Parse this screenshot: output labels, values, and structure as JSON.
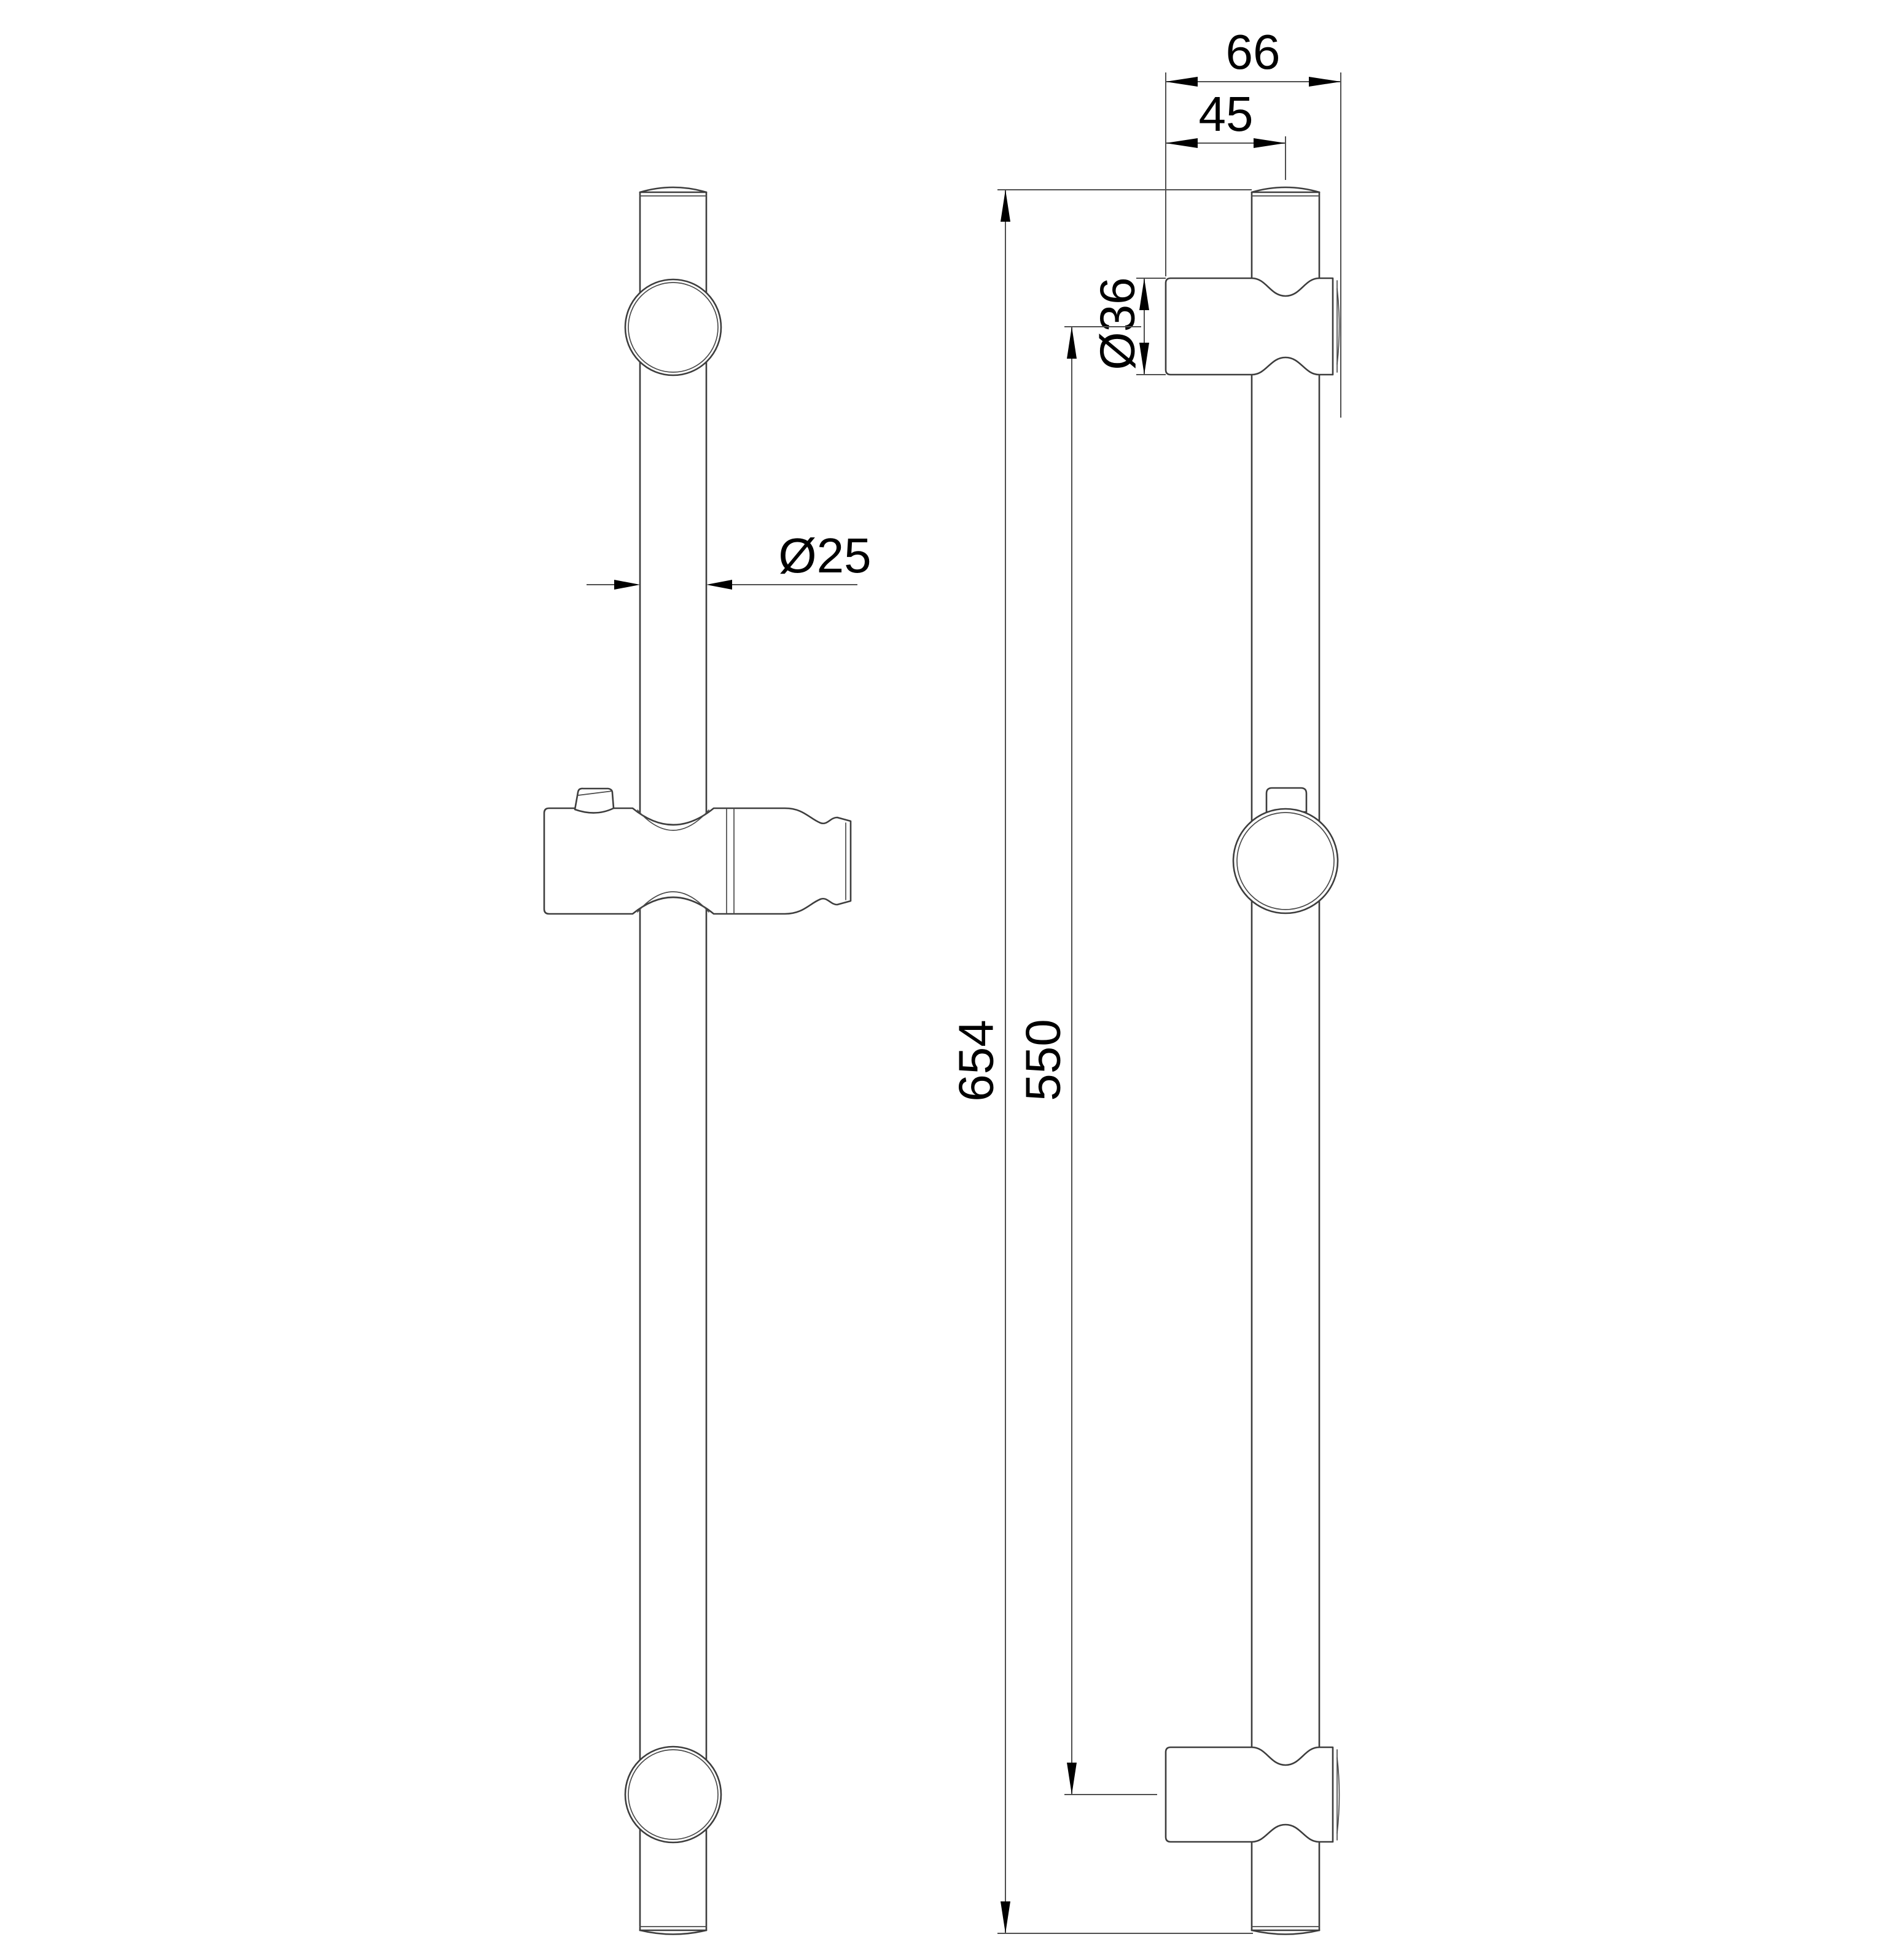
{
  "drawing": {
    "colors": {
      "background": "#ffffff",
      "object_line": "#3d3d3d",
      "dimension_line": "#4f4f4f",
      "text": "#000000"
    },
    "dimensions": {
      "bracket_depth": "66",
      "bar_axis_to_front": "45",
      "bracket_diameter": "Ø36",
      "bar_diameter": "Ø25",
      "overall_length": "654",
      "bracket_center_distance": "550"
    }
  }
}
